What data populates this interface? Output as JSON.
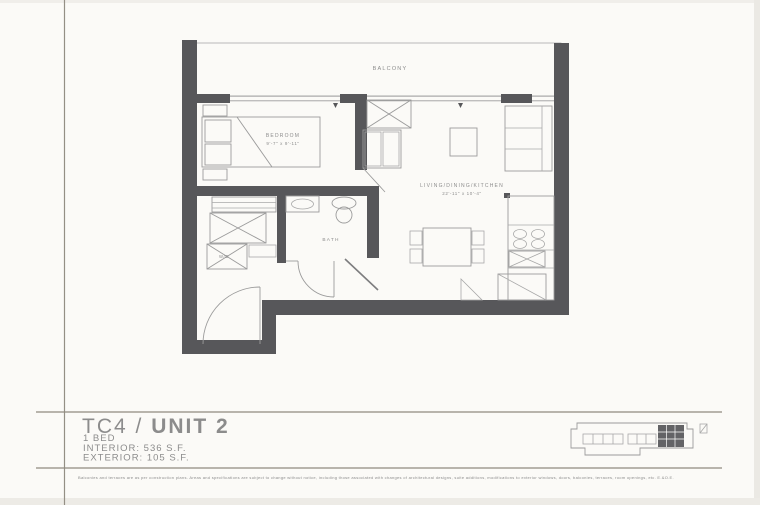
{
  "colors": {
    "paper": "#fbfaf7",
    "wall": "#57575a",
    "drawing_line": "#9b9b9b",
    "label_text": "#8c8c8c",
    "title_text": "#9e9c98",
    "rule_line": "#8f8a80",
    "keyplan_highlight": "#636366"
  },
  "title_block": {
    "title_prefix": "TC4 / ",
    "title_main": "UNIT 2",
    "bed_count": "1 BED",
    "interior_area": "INTERIOR: 536 S.F.",
    "exterior_area": "EXTERIOR: 105 S.F."
  },
  "plan": {
    "rooms": {
      "balcony": {
        "label": "BALCONY"
      },
      "bedroom": {
        "label": "BEDROOM",
        "dimensions": "9'-7\" x 9'-11\""
      },
      "living_dining_kitchen": {
        "label": "LIVING/DINING/KITCHEN",
        "dimensions": "22'-11\" x 10'-4\""
      },
      "bath": {
        "label": "BATH"
      },
      "laundry": {
        "label": "W/D"
      }
    }
  },
  "disclaimer": "Balconies and terraces are as per construction plans. Areas and specifications are subject to change without notice, including those associated with changes of architectural designs, suite additions, modifications to exterior windows, doors, balconies, terraces, room openings, etc. E.&O.E."
}
